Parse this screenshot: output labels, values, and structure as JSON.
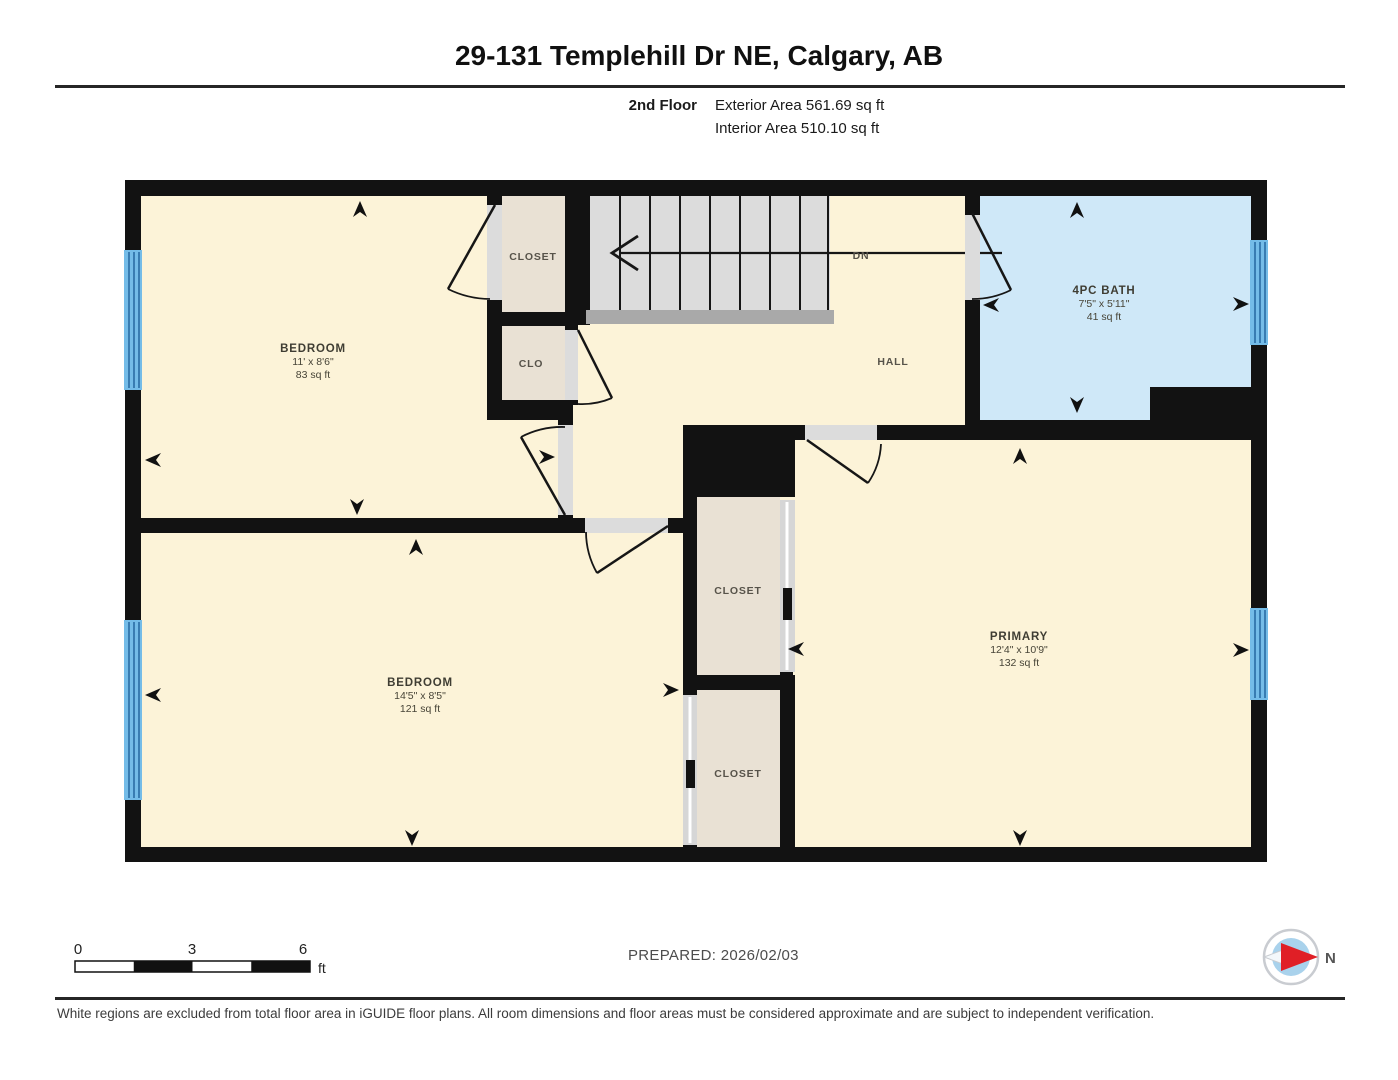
{
  "header": {
    "title": "29-131 Templehill Dr NE, Calgary, AB"
  },
  "floor_info": {
    "floor": "2nd Floor",
    "exterior_area": "Exterior Area 561.69 sq ft",
    "interior_area": "Interior Area 510.10 sq ft"
  },
  "rooms": {
    "bedroom1": {
      "name": "BEDROOM",
      "dims": "11' x 8'6\"",
      "area": "83 sq ft"
    },
    "bedroom2": {
      "name": "BEDROOM",
      "dims": "14'5\" x 8'5\"",
      "area": "121 sq ft"
    },
    "primary": {
      "name": "PRIMARY",
      "dims": "12'4\" x 10'9\"",
      "area": "132 sq ft"
    },
    "bath": {
      "name": "4PC BATH",
      "dims": "7'5\" x 5'11\"",
      "area": "41 sq ft"
    },
    "closet_top": {
      "name": "CLOSET"
    },
    "clo": {
      "name": "CLO"
    },
    "hall": {
      "name": "HALL"
    },
    "stairs_dn": {
      "label": "DN"
    },
    "closet_mid": {
      "name": "CLOSET"
    },
    "closet_bottom": {
      "name": "CLOSET"
    }
  },
  "scale_bar": {
    "tick0": "0",
    "tick3": "3",
    "tick6": "6",
    "unit": "ft"
  },
  "prepared": {
    "label": "PREPARED: 2026/02/03"
  },
  "compass": {
    "north_label": "N"
  },
  "footer": {
    "disclaimer": "White regions are excluded from total floor area in iGUIDE floor plans. All room dimensions and floor areas must be considered approximate and are subject to independent verification."
  },
  "colors": {
    "room_fill": "#fcf3d8",
    "closet_fill": "#e9e1d4",
    "bath_fill": "#cfe8f8",
    "stairs_fill": "#dcdcdc",
    "stair_landing": "#a9a9a9",
    "window_blue": "#74bce8",
    "window_line": "#2a6da4",
    "wall": "#121212",
    "door_opening": "#dcdcdc",
    "compass_red": "#e01f26",
    "compass_blue": "#a9d2ec"
  }
}
